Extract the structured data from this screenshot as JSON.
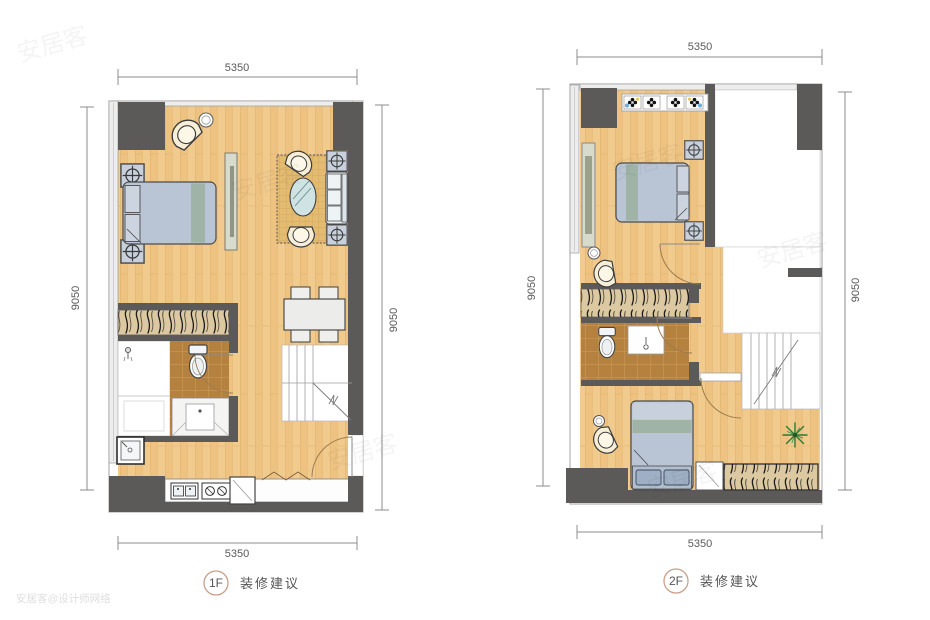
{
  "plans": [
    {
      "name": "1F",
      "badge": "1F",
      "label": "装修建议",
      "dims": {
        "top": "5350",
        "bottom": "5350",
        "left": "9050",
        "right": "9050"
      }
    },
    {
      "name": "2F",
      "badge": "2F",
      "label": "装修建议",
      "dims": {
        "top": "5350",
        "bottom": "5350",
        "left": "9050",
        "right": "9050"
      }
    }
  ],
  "watermark": {
    "brand": "安居客",
    "credit": "安居客@设计师网络"
  },
  "colors": {
    "wood": "#f1cb8e",
    "wall": "#5c5a58",
    "tile": "#b5813f",
    "rug": "#e3bb71",
    "furniture_blue": "#b9c4d4",
    "cream_chair": "#f6eed6",
    "wardrobe": "#dcc9a2",
    "badge_ring": "#c9a08a",
    "dimension_text": "#5a5a5a",
    "plant": "#2f7a35"
  }
}
